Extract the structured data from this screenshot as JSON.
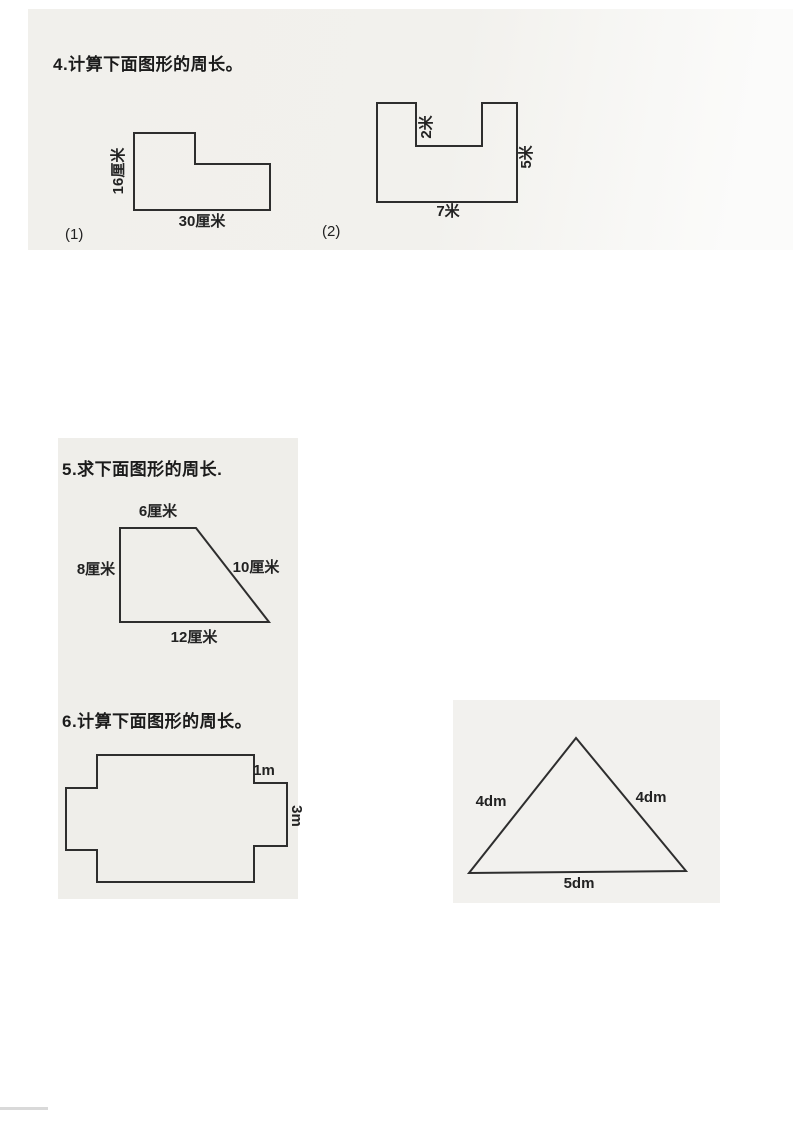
{
  "problem4": {
    "title": "4.计算下面图形的周长。",
    "figure1": {
      "index_label": "(1)",
      "left_label": "16厘米",
      "bottom_label": "30厘米"
    },
    "figure2": {
      "index_label": "(2)",
      "notch_label": "2米",
      "right_label": "5米",
      "bottom_label": "7米"
    }
  },
  "problem5": {
    "title": "5.求下面图形的周长.",
    "trapezoid": {
      "top_label": "6厘米",
      "left_label": "8厘米",
      "right_label": "10厘米",
      "bottom_label": "12厘米"
    }
  },
  "problem6": {
    "title": "6.计算下面图形的周长。",
    "cross_figure": {
      "top_right_label": "1m",
      "right_label": "3m"
    },
    "triangle_figure": {
      "left_label": "4dm",
      "right_label": "4dm",
      "bottom_label": "5dm"
    }
  }
}
